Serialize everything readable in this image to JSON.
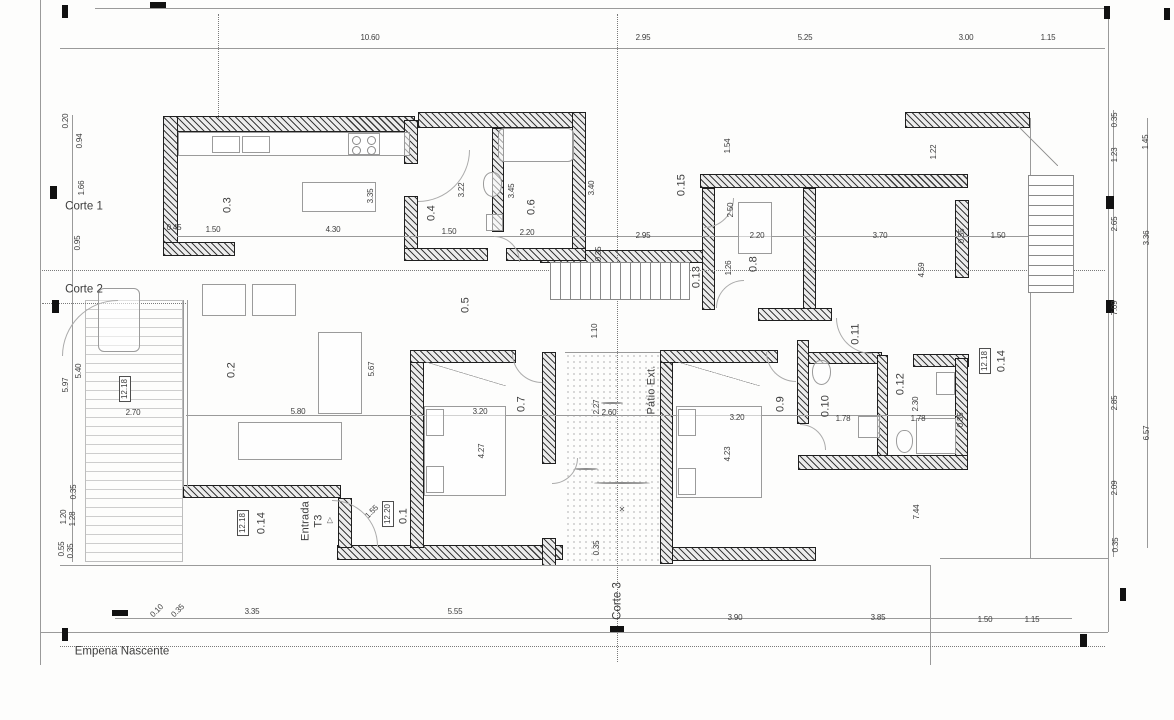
{
  "sheet": {
    "type": "architectural floor plan",
    "section_labels": [
      "Corte 1",
      "Corte 2",
      "Corte 3"
    ],
    "facade_label": "Empena Nascente",
    "room_ids": [
      "0.1",
      "0.2",
      "0.3",
      "0.4",
      "0.5",
      "0.6",
      "0.7",
      "0.8",
      "0.9",
      "0.10",
      "0.11",
      "0.12",
      "0.13",
      "0.14",
      "0.15"
    ],
    "area_labels": [
      "Pátio Ext.",
      "Entrada T3"
    ],
    "level_refs": [
      "12.18",
      "12.20"
    ],
    "ink_color": "#3d3d3d",
    "wall_color": "#3c3c3c"
  },
  "annotations": [
    {
      "t": "10.60",
      "x": 370,
      "y": 38,
      "r": 0,
      "k": "dim"
    },
    {
      "t": "2.95",
      "x": 643,
      "y": 38,
      "r": 0,
      "k": "dim"
    },
    {
      "t": "5.25",
      "x": 805,
      "y": 38,
      "r": 0,
      "k": "dim"
    },
    {
      "t": "3.00",
      "x": 966,
      "y": 38,
      "r": 0,
      "k": "dim"
    },
    {
      "t": "1.15",
      "x": 1048,
      "y": 38,
      "r": 0,
      "k": "dim"
    },
    {
      "t": "0.10",
      "x": 157,
      "y": 611,
      "r": -45,
      "k": "dim"
    },
    {
      "t": "0.35",
      "x": 178,
      "y": 611,
      "r": -45,
      "k": "dim"
    },
    {
      "t": "3.35",
      "x": 252,
      "y": 612,
      "r": 0,
      "k": "dim"
    },
    {
      "t": "5.55",
      "x": 455,
      "y": 612,
      "r": 0,
      "k": "dim"
    },
    {
      "t": "3.90",
      "x": 735,
      "y": 618,
      "r": 0,
      "k": "dim"
    },
    {
      "t": "3.85",
      "x": 878,
      "y": 618,
      "r": 0,
      "k": "dim"
    },
    {
      "t": "1.50",
      "x": 985,
      "y": 620,
      "r": 0,
      "k": "dim"
    },
    {
      "t": "1.15",
      "x": 1032,
      "y": 620,
      "r": 0,
      "k": "dim"
    },
    {
      "t": "0.20",
      "x": 66,
      "y": 121,
      "r": -90,
      "k": "dim"
    },
    {
      "t": "0.94",
      "x": 80,
      "y": 141,
      "r": -90,
      "k": "dim"
    },
    {
      "t": "1.66",
      "x": 82,
      "y": 188,
      "r": -90,
      "k": "dim"
    },
    {
      "t": "0.95",
      "x": 78,
      "y": 243,
      "r": -90,
      "k": "dim"
    },
    {
      "t": "5.97",
      "x": 66,
      "y": 385,
      "r": -90,
      "k": "dim"
    },
    {
      "t": "5.40",
      "x": 79,
      "y": 371,
      "r": -90,
      "k": "dim"
    },
    {
      "t": "2.70",
      "x": 133,
      "y": 413,
      "r": 0,
      "k": "dim"
    },
    {
      "t": "0.35",
      "x": 74,
      "y": 492,
      "r": -90,
      "k": "dim"
    },
    {
      "t": "1.20",
      "x": 64,
      "y": 517,
      "r": -90,
      "k": "dim"
    },
    {
      "t": "1.28",
      "x": 73,
      "y": 519,
      "r": -90,
      "k": "dim"
    },
    {
      "t": "0.55",
      "x": 62,
      "y": 549,
      "r": -90,
      "k": "dim"
    },
    {
      "t": "0.35",
      "x": 71,
      "y": 551,
      "r": -90,
      "k": "dim"
    },
    {
      "t": "12.18",
      "x": 125,
      "y": 389,
      "r": -90,
      "k": "box"
    },
    {
      "t": "0.35",
      "x": 1115,
      "y": 120,
      "r": -90,
      "k": "dim"
    },
    {
      "t": "1.45",
      "x": 1146,
      "y": 142,
      "r": -90,
      "k": "dim"
    },
    {
      "t": "1.23",
      "x": 1115,
      "y": 155,
      "r": -90,
      "k": "dim"
    },
    {
      "t": "2.65",
      "x": 1115,
      "y": 224,
      "r": -90,
      "k": "dim"
    },
    {
      "t": "3.36",
      "x": 1147,
      "y": 238,
      "r": -90,
      "k": "dim"
    },
    {
      "t": "7.09",
      "x": 1115,
      "y": 308,
      "r": -90,
      "k": "dim"
    },
    {
      "t": "2.85",
      "x": 1115,
      "y": 403,
      "r": -90,
      "k": "dim"
    },
    {
      "t": "6.57",
      "x": 1147,
      "y": 433,
      "r": -90,
      "k": "dim"
    },
    {
      "t": "2.09",
      "x": 1115,
      "y": 488,
      "r": -90,
      "k": "dim"
    },
    {
      "t": "0.35",
      "x": 1116,
      "y": 545,
      "r": -90,
      "k": "dim"
    },
    {
      "t": "0.3",
      "x": 228,
      "y": 205,
      "r": -90,
      "k": "room"
    },
    {
      "t": "0.4",
      "x": 432,
      "y": 213,
      "r": -90,
      "k": "room"
    },
    {
      "t": "0.6",
      "x": 532,
      "y": 207,
      "r": -90,
      "k": "room"
    },
    {
      "t": "0.15",
      "x": 682,
      "y": 185,
      "r": -90,
      "k": "room"
    },
    {
      "t": "0.8",
      "x": 754,
      "y": 264,
      "r": -90,
      "k": "room"
    },
    {
      "t": "0.13",
      "x": 697,
      "y": 277,
      "r": -90,
      "k": "room"
    },
    {
      "t": "0.5",
      "x": 466,
      "y": 305,
      "r": -90,
      "k": "room"
    },
    {
      "t": "0.11",
      "x": 856,
      "y": 334,
      "r": -90,
      "k": "room"
    },
    {
      "t": "0.2",
      "x": 232,
      "y": 370,
      "r": -90,
      "k": "room"
    },
    {
      "t": "0.7",
      "x": 522,
      "y": 404,
      "r": -90,
      "k": "room"
    },
    {
      "t": "0.9",
      "x": 781,
      "y": 404,
      "r": -90,
      "k": "room"
    },
    {
      "t": "0.10",
      "x": 826,
      "y": 406,
      "r": -90,
      "k": "room"
    },
    {
      "t": "0.12",
      "x": 901,
      "y": 384,
      "r": -90,
      "k": "room"
    },
    {
      "t": "0.14",
      "x": 1002,
      "y": 361,
      "r": -90,
      "k": "room"
    },
    {
      "t": "12.18",
      "x": 985,
      "y": 361,
      "r": -90,
      "k": "box"
    },
    {
      "t": "0.14",
      "x": 262,
      "y": 523,
      "r": -90,
      "k": "room"
    },
    {
      "t": "12.18",
      "x": 243,
      "y": 523,
      "r": -90,
      "k": "box"
    },
    {
      "t": "0.1",
      "x": 404,
      "y": 516,
      "r": -90,
      "k": "room"
    },
    {
      "t": "12.20",
      "x": 388,
      "y": 514,
      "r": -90,
      "k": "box"
    },
    {
      "t": "Pátio Ext.",
      "x": 652,
      "y": 390,
      "r": -90,
      "k": "room"
    },
    {
      "t": "Entrada",
      "x": 306,
      "y": 521,
      "r": -90,
      "k": "room"
    },
    {
      "t": "T3",
      "x": 319,
      "y": 521,
      "r": -90,
      "k": "room"
    },
    {
      "t": "▷",
      "x": 330,
      "y": 520,
      "r": -90,
      "k": "icon"
    },
    {
      "t": "Corte 1",
      "x": 84,
      "y": 207,
      "r": 0,
      "k": "title"
    },
    {
      "t": "Corte 2",
      "x": 84,
      "y": 290,
      "r": 0,
      "k": "title"
    },
    {
      "t": "Corte 3",
      "x": 618,
      "y": 601,
      "r": -90,
      "k": "title"
    },
    {
      "t": "Empena Nascente",
      "x": 122,
      "y": 652,
      "r": 0,
      "k": "title"
    },
    {
      "t": "0.45",
      "x": 174,
      "y": 228,
      "r": 0,
      "k": "dim"
    },
    {
      "t": "1.50",
      "x": 213,
      "y": 230,
      "r": 0,
      "k": "dim"
    },
    {
      "t": "4.30",
      "x": 333,
      "y": 230,
      "r": 0,
      "k": "dim"
    },
    {
      "t": "3.35",
      "x": 371,
      "y": 196,
      "r": -90,
      "k": "dim"
    },
    {
      "t": "3.22",
      "x": 462,
      "y": 190,
      "r": -90,
      "k": "dim"
    },
    {
      "t": "1.50",
      "x": 449,
      "y": 232,
      "r": 0,
      "k": "dim"
    },
    {
      "t": "3.45",
      "x": 512,
      "y": 191,
      "r": -90,
      "k": "dim"
    },
    {
      "t": "2.20",
      "x": 527,
      "y": 233,
      "r": 0,
      "k": "dim"
    },
    {
      "t": "3.40",
      "x": 592,
      "y": 188,
      "r": -90,
      "k": "dim"
    },
    {
      "t": "1.54",
      "x": 728,
      "y": 146,
      "r": -90,
      "k": "dim"
    },
    {
      "t": "2.95",
      "x": 643,
      "y": 236,
      "r": 0,
      "k": "dim"
    },
    {
      "t": "2.50",
      "x": 731,
      "y": 210,
      "r": -90,
      "k": "dim"
    },
    {
      "t": "1.26",
      "x": 729,
      "y": 268,
      "r": -90,
      "k": "dim"
    },
    {
      "t": "2.20",
      "x": 757,
      "y": 236,
      "r": 0,
      "k": "dim"
    },
    {
      "t": "3.70",
      "x": 880,
      "y": 236,
      "r": 0,
      "k": "dim"
    },
    {
      "t": "0.35",
      "x": 962,
      "y": 236,
      "r": -90,
      "k": "dim"
    },
    {
      "t": "1.50",
      "x": 998,
      "y": 236,
      "r": 0,
      "k": "dim"
    },
    {
      "t": "1.22",
      "x": 934,
      "y": 152,
      "r": -90,
      "k": "dim"
    },
    {
      "t": "4.59",
      "x": 922,
      "y": 270,
      "r": -90,
      "k": "dim"
    },
    {
      "t": "0.35",
      "x": 599,
      "y": 254,
      "r": -90,
      "k": "dim"
    },
    {
      "t": "1.10",
      "x": 595,
      "y": 331,
      "r": -90,
      "k": "dim"
    },
    {
      "t": "5.80",
      "x": 298,
      "y": 412,
      "r": 0,
      "k": "dim"
    },
    {
      "t": "5.67",
      "x": 372,
      "y": 369,
      "r": -90,
      "k": "dim"
    },
    {
      "t": "3.20",
      "x": 480,
      "y": 412,
      "r": 0,
      "k": "dim"
    },
    {
      "t": "4.27",
      "x": 482,
      "y": 451,
      "r": -90,
      "k": "dim"
    },
    {
      "t": "2.60",
      "x": 609,
      "y": 413,
      "r": 0,
      "k": "dim"
    },
    {
      "t": "2.27",
      "x": 597,
      "y": 407,
      "r": -90,
      "k": "dim"
    },
    {
      "t": "0.35",
      "x": 597,
      "y": 548,
      "r": -90,
      "k": "dim"
    },
    {
      "t": "3.20",
      "x": 737,
      "y": 418,
      "r": 0,
      "k": "dim"
    },
    {
      "t": "4.23",
      "x": 728,
      "y": 454,
      "r": -90,
      "k": "dim"
    },
    {
      "t": "1.78",
      "x": 843,
      "y": 419,
      "r": 0,
      "k": "dim"
    },
    {
      "t": "2.30",
      "x": 916,
      "y": 404,
      "r": -90,
      "k": "dim"
    },
    {
      "t": "1.78",
      "x": 918,
      "y": 419,
      "r": 0,
      "k": "dim"
    },
    {
      "t": "0.35",
      "x": 961,
      "y": 420,
      "r": -90,
      "k": "dim"
    },
    {
      "t": "7.44",
      "x": 917,
      "y": 512,
      "r": -90,
      "k": "dim"
    },
    {
      "t": "1.55",
      "x": 372,
      "y": 512,
      "r": -45,
      "k": "dim"
    },
    {
      "t": "✕",
      "x": 622,
      "y": 510,
      "r": 0,
      "k": "icon"
    }
  ]
}
